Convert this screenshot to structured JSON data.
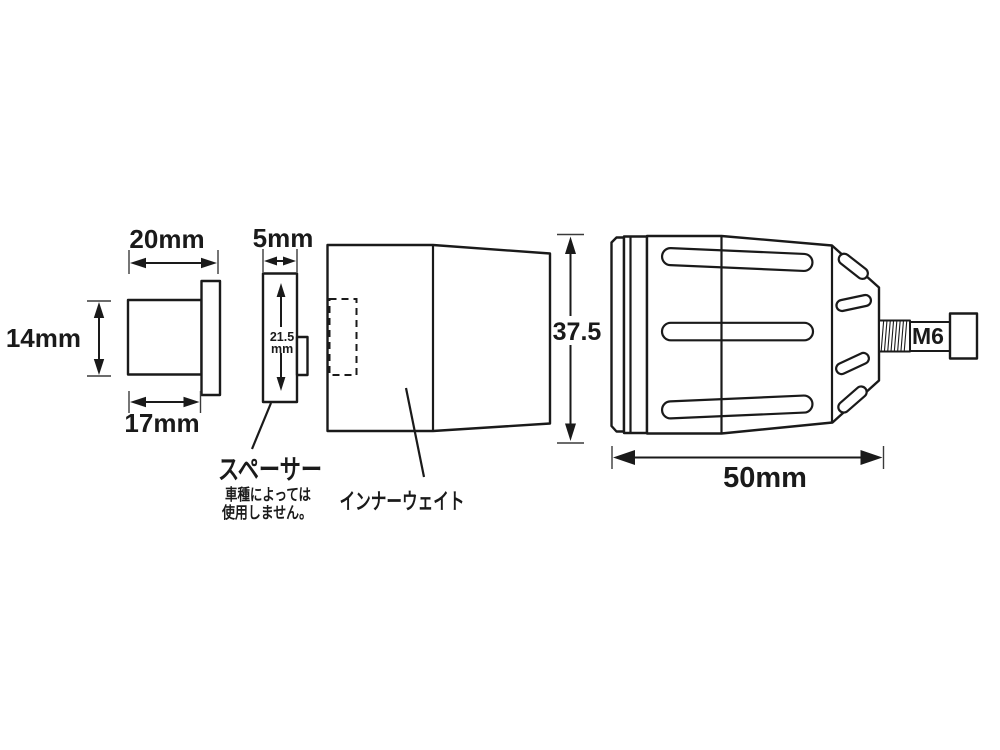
{
  "colors": {
    "background": "#ffffff",
    "line": "#1a1a1a"
  },
  "parts": {
    "end_cap": {
      "dim_top_width": "20mm",
      "dim_height": "14mm",
      "dim_bottom_width": "17mm"
    },
    "spacer": {
      "dim_thickness": "5mm",
      "dim_height_value": "21.5",
      "dim_height_unit": "mm",
      "label": "スペーサー",
      "note_line1": "車種によっては",
      "note_line2": "使用しません。"
    },
    "inner_weight": {
      "label": "インナーウェイト",
      "dim_height": "37.5"
    },
    "bar_end": {
      "dim_length": "50mm",
      "bolt_size": "M6"
    }
  }
}
